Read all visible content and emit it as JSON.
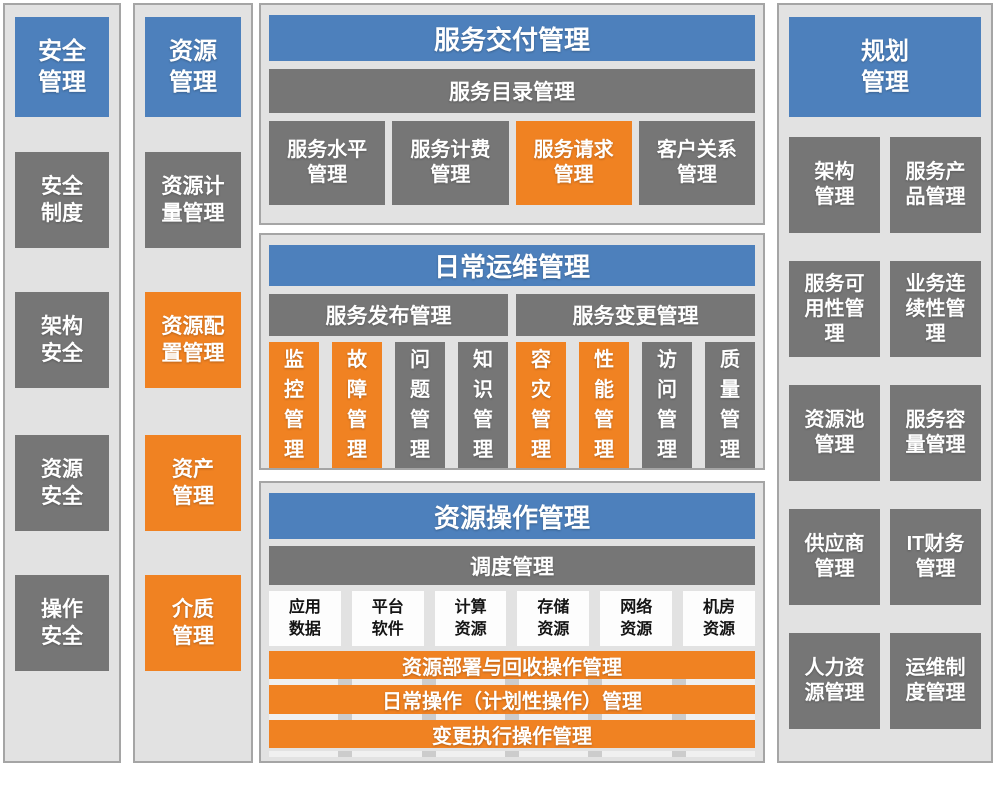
{
  "colors": {
    "header_blue": "#4D80BC",
    "block_gray": "#767676",
    "block_orange": "#F08222",
    "panel_background": "#E2E2E2",
    "panel_border": "#A5A5A5"
  },
  "security": {
    "title": "安全\n管理",
    "items": [
      {
        "label": "安全\n制度",
        "variant": "gray"
      },
      {
        "label": "架构\n安全",
        "variant": "gray"
      },
      {
        "label": "资源\n安全",
        "variant": "gray"
      },
      {
        "label": "操作\n安全",
        "variant": "gray"
      }
    ]
  },
  "resource": {
    "title": "资源\n管理",
    "items": [
      {
        "label": "资源计\n量管理",
        "variant": "gray"
      },
      {
        "label": "资源配\n置管理",
        "variant": "orange"
      },
      {
        "label": "资产\n管理",
        "variant": "orange"
      },
      {
        "label": "介质\n管理",
        "variant": "orange"
      }
    ]
  },
  "service_delivery": {
    "title": "服务交付管理",
    "catalog_bar": "服务目录管理",
    "items": [
      {
        "label": "服务水平\n管理",
        "variant": "gray"
      },
      {
        "label": "服务计费\n管理",
        "variant": "gray"
      },
      {
        "label": "服务请求\n管理",
        "variant": "orange"
      },
      {
        "label": "客户关系\n管理",
        "variant": "gray"
      }
    ]
  },
  "daily_ops": {
    "title": "日常运维管理",
    "groups": [
      {
        "bar": "服务发布管理",
        "items": [
          {
            "label": "监\n控\n管\n理",
            "variant": "orange"
          },
          {
            "label": "故\n障\n管\n理",
            "variant": "orange"
          },
          {
            "label": "问\n题\n管\n理",
            "variant": "gray"
          },
          {
            "label": "知\n识\n管\n理",
            "variant": "gray"
          }
        ]
      },
      {
        "bar": "服务变更管理",
        "items": [
          {
            "label": "容\n灾\n管\n理",
            "variant": "orange"
          },
          {
            "label": "性\n能\n管\n理",
            "variant": "orange"
          },
          {
            "label": "访\n问\n管\n理",
            "variant": "gray"
          },
          {
            "label": "质\n量\n管\n理",
            "variant": "gray"
          }
        ]
      }
    ]
  },
  "resource_ops": {
    "title": "资源操作管理",
    "schedule_bar": "调度管理",
    "resources": [
      "应用\n数据",
      "平台\n软件",
      "计算\n资源",
      "存储\n资源",
      "网络\n资源",
      "机房\n资源"
    ],
    "bars": [
      "资源部署与回收操作管理",
      "日常操作（计划性操作）管理",
      "变更执行操作管理"
    ]
  },
  "planning": {
    "title": "规划\n管理",
    "items": [
      {
        "label": "架构\n管理"
      },
      {
        "label": "服务产\n品管理"
      },
      {
        "label": "服务可\n用性管\n理"
      },
      {
        "label": "业务连\n续性管\n理"
      },
      {
        "label": "资源池\n管理"
      },
      {
        "label": "服务容\n量管理"
      },
      {
        "label": "供应商\n管理"
      },
      {
        "label": "IT财务\n管理"
      },
      {
        "label": "人力资\n源管理"
      },
      {
        "label": "运维制\n度管理"
      }
    ]
  }
}
